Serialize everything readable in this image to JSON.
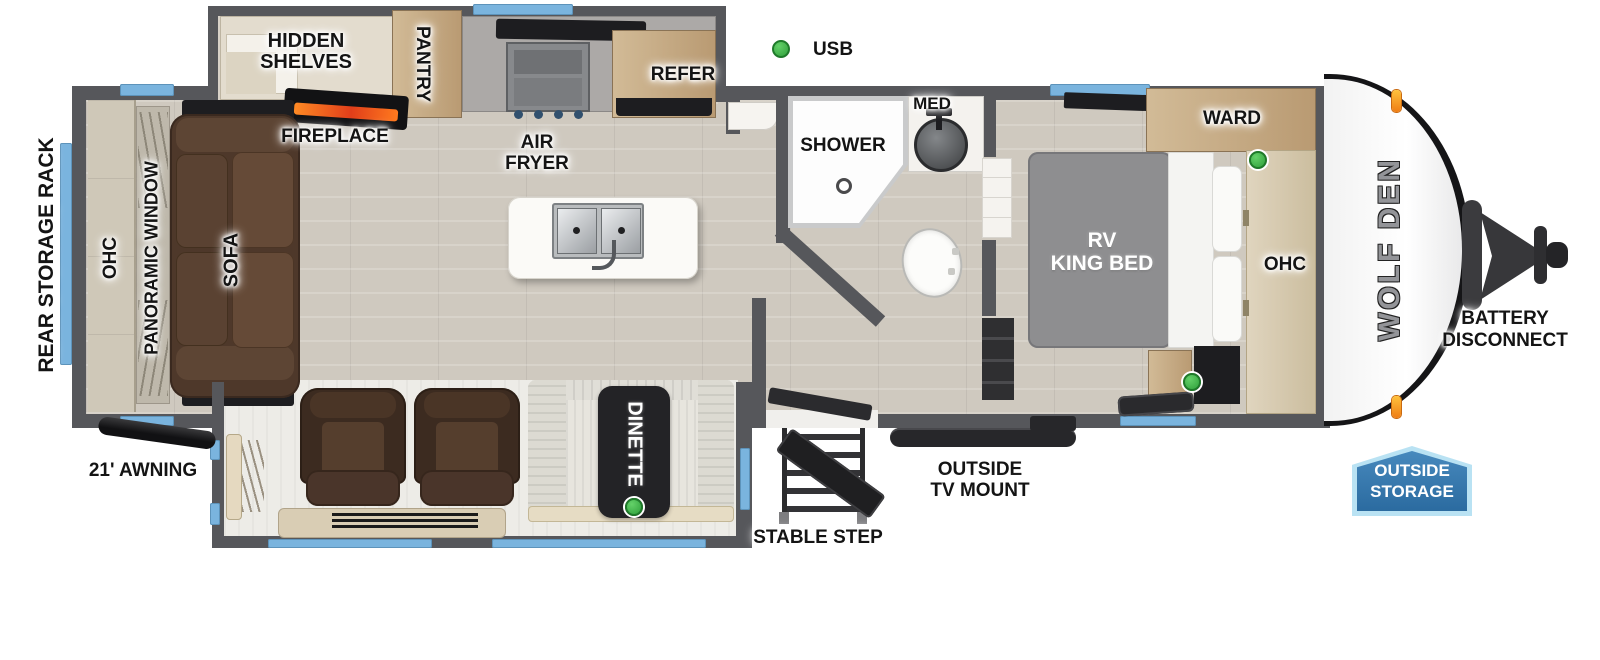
{
  "brand": {
    "logo": "WOLF DEN"
  },
  "legend": {
    "usb": "USB"
  },
  "labels": {
    "rear_storage_rack": "REAR STORAGE RACK",
    "ohc_rear": "OHC",
    "panoramic_window": "PANORAMIC WINDOW",
    "sofa": "SOFA",
    "hidden_shelves": [
      "HIDDEN",
      "SHELVES"
    ],
    "pantry": "PANTRY",
    "fireplace": "FIREPLACE",
    "air_fryer": [
      "AIR",
      "FRYER"
    ],
    "refer": "REFER",
    "shower": "SHOWER",
    "med": "MED",
    "ward": "WARD",
    "rv_king_bed": [
      "RV",
      "KING BED"
    ],
    "ohc_front": "OHC",
    "battery_disconnect": [
      "BATTERY",
      "DISCONNECT"
    ],
    "awning": "21' AWNING",
    "dinette": "DINETTE",
    "outside_tv_mount": [
      "OUTSIDE",
      "TV MOUNT"
    ],
    "stable_step": "STABLE STEP",
    "outside_storage": [
      "OUTSIDE",
      "STORAGE"
    ]
  },
  "colors": {
    "wall_gray": "#56575b",
    "window_blue": "#7ab4de",
    "usb_green": "#3fb54a",
    "fireplace_orange": "#f26722",
    "sofa_brown": "#4e382a",
    "cabinet_wood": "#c9ae8a",
    "badge_blue": "#2f6fa6",
    "badge_border": "#b9e2f3",
    "marker_light_orange": "#f59a1e"
  }
}
